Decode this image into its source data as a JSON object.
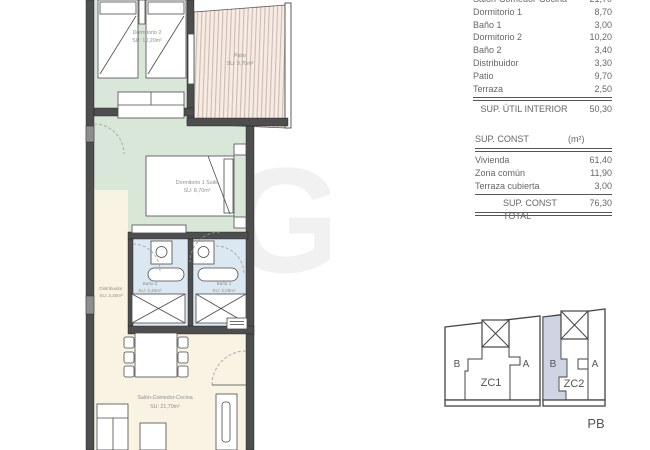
{
  "plan": {
    "watermark": "SG",
    "rooms": {
      "dormitorio2": {
        "name": "Dormitorio 2",
        "area": "SU: 10,20m²"
      },
      "patio": {
        "name": "Patio",
        "area": "SU: 9,70m²"
      },
      "dormitorio1": {
        "name": "Dormitorio 1 Suite",
        "area": "SU: 8,70m²"
      },
      "bano2": {
        "name": "Baño 2",
        "area": "SU: 3,40m²"
      },
      "bano1": {
        "name": "Baño 1",
        "area": "SU: 3,00m²"
      },
      "distribuidor": {
        "name": "Distribuidor",
        "area": "SU: 3,30m²"
      },
      "salon": {
        "name": "Salón-Comedor-Cocina",
        "area": "SU: 21,70m²"
      }
    }
  },
  "util_table": {
    "clipped_row": {
      "label": "Salón-Comedor-Cocina",
      "value": "21,70"
    },
    "rows": [
      {
        "label": "Dormitorio 1",
        "value": "8,70"
      },
      {
        "label": "Baño 1",
        "value": "3,00"
      },
      {
        "label": "Dormitorio 2",
        "value": "10,20"
      },
      {
        "label": "Baño 2",
        "value": "3,40"
      },
      {
        "label": "Distribuidor",
        "value": "3,30"
      },
      {
        "label": "Patio",
        "value": "9,70"
      },
      {
        "label": "Terraza",
        "value": "2,50"
      }
    ],
    "total_label": "SUP. ÚTIL INTERIOR",
    "total_value": "50,30"
  },
  "const_table": {
    "header_label": "SUP. CONST",
    "header_unit": "(m²)",
    "rows": [
      {
        "label": "Vivienda",
        "value": "61,40"
      },
      {
        "label": "Zona común",
        "value": "11,90"
      },
      {
        "label": "Terraza cubierta",
        "value": "3,00"
      }
    ],
    "total_label": "SUP. CONST TOTAL",
    "total_value": "76,30"
  },
  "keyplan": {
    "block1": {
      "left": "B",
      "right": "A",
      "zone": "ZC1"
    },
    "block2": {
      "left": "B",
      "right": "A",
      "zone": "ZC2"
    },
    "floor_label": "PB"
  },
  "colors": {
    "floor_green": "#d9e7d9",
    "floor_blue": "#dbe8f2",
    "floor_cream": "#f8f3e2",
    "patio_bg": "#f7ece4",
    "patio_stripe": "#c9b6ac",
    "wall": "#4e4e4e",
    "highlight": "#cdd5e3",
    "text": "#666666"
  }
}
